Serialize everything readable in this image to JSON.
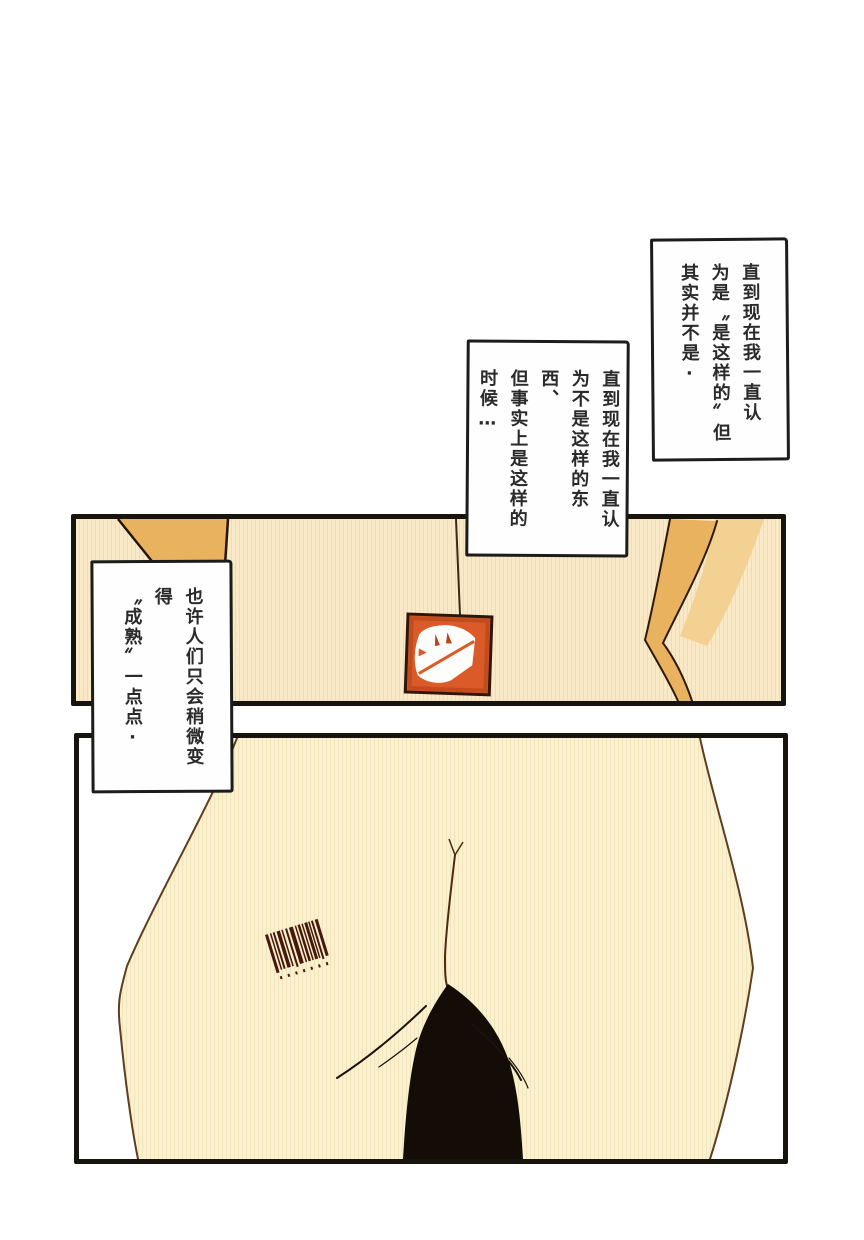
{
  "page": {
    "background": "#ffffff",
    "type": "manga-page"
  },
  "bubbles": {
    "top_right": {
      "text": "直到现在我一直认\n为是〝是这样的〞但\n其实并不是·"
    },
    "middle": {
      "text": "直到现在我一直认\n为不是这样的东西、\n但事实上是这样的\n时候…"
    },
    "left": {
      "text": "也许人们只会稍微变得\n〝成熟〞一点点·"
    }
  },
  "icons": {
    "parcel": "dog-parcel-icon",
    "barcode": "barcode-icon"
  },
  "colors": {
    "panel_border": "#17130d",
    "bubble_border": "#1c1c1c",
    "panel1_bg": "#f9e9c6",
    "panel1_stripe": "#f1dcb0",
    "tan_shape": "#e9b25f",
    "tan_light": "#f2d193",
    "outline_brown": "#5f3d1e",
    "body_fill": "#faf1d3",
    "body_stripe": "#f3e5ba",
    "parcel_orange": "#db5a2a",
    "parcel_rim": "#b94517",
    "hair_black": "#140d07",
    "barcode_ink": "#45190d"
  }
}
